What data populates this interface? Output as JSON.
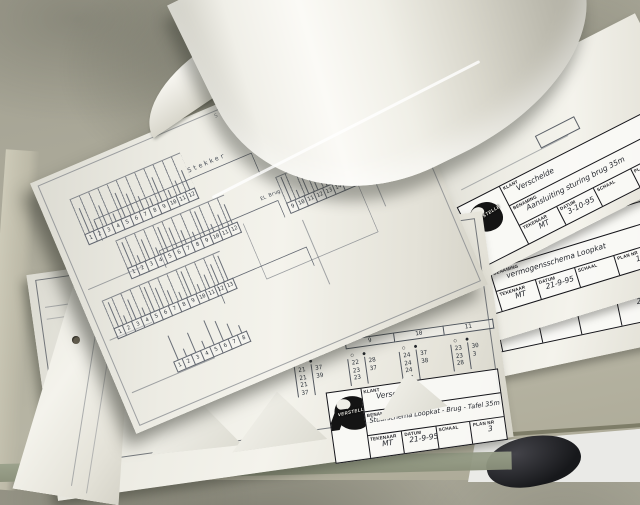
{
  "logo_text": "VERSTELLE",
  "tb_labels": {
    "klant": "KLANT",
    "benaming": "BENAMING",
    "tekenaar": "TEKENAAR",
    "datum": "DATUM",
    "schaal": "SCHAAL",
    "plan_nr": "PLAN NR"
  },
  "blocks": {
    "plan4": {
      "klant": "Verschelde",
      "benaming": "Aansluiting sturing brug 35m",
      "tekenaar": "MT",
      "datum": "3-10-95",
      "schaal": "",
      "plan_nr": "4"
    },
    "plan1": {
      "klant": "Verschelde",
      "benaming": "vermogensschema Loopkat",
      "tekenaar": "MT",
      "datum": "21-9-95",
      "schaal": "",
      "plan_nr": "1"
    },
    "plan2": {
      "klant": "Verschelde",
      "benaming": "vermogensschema Tafel - Brug",
      "tekenaar": "MT",
      "datum": "21-9-95",
      "schaal": "",
      "plan_nr": "2"
    },
    "plan3": {
      "klant": "Verschelde",
      "benaming": "Stuurschema Loopkat - Brug - Tafel 35m",
      "tekenaar": "MT",
      "datum": "21-9-95",
      "schaal": "",
      "plan_nr": "3"
    }
  },
  "schematic": {
    "labels": {
      "stekker": "Stekker",
      "klemmen_kast": "Klemmen kast",
      "el_brug": "EL Brug",
      "x5": "X5",
      "x2": "X2"
    },
    "strips": {
      "a": [
        "1",
        "2",
        "3",
        "4",
        "5",
        "6",
        "7",
        "8",
        "9",
        "10",
        "11",
        "12"
      ],
      "b": [
        "1",
        "2",
        "3",
        "4",
        "5",
        "6",
        "7",
        "8",
        "9",
        "10",
        "11",
        "12"
      ],
      "c": [
        "1",
        "2",
        "3",
        "4",
        "5",
        "6",
        "7",
        "8",
        "9",
        "10",
        "11",
        "12",
        "13"
      ],
      "d": [
        "1",
        "2",
        "3",
        "4",
        "5",
        "6",
        "7",
        "8"
      ],
      "e": [
        "9",
        "10",
        "11",
        "12",
        "13",
        "14",
        "15",
        "16",
        "17",
        "18"
      ],
      "f": [
        "19",
        "20",
        "21",
        "22",
        "23"
      ]
    },
    "relays": [
      "K0",
      "A1",
      "A2",
      "K1",
      "K2"
    ]
  },
  "tables": {
    "sym_open": "○",
    "sym_filled": "●",
    "left": {
      "headers": [
        "1",
        "2"
      ],
      "groups": [
        {
          "circle": [
            "11",
            "11",
            "12",
            "34"
          ],
          "dot": []
        },
        {
          "circle": [
            "15",
            "14",
            "14"
          ],
          "dot": [
            "13"
          ]
        }
      ]
    },
    "right": {
      "headers": [
        "9",
        "10",
        "11"
      ],
      "groups": [
        {
          "circle": [
            "21",
            "21",
            "21",
            "37"
          ],
          "dot": [
            "37",
            "39"
          ]
        },
        {
          "circle": [
            "22",
            "23",
            "23"
          ],
          "dot": [
            "28",
            "37"
          ]
        },
        {
          "circle": [
            "24",
            "24",
            "24",
            "37"
          ],
          "dot": [
            "37",
            "38"
          ]
        },
        {
          "circle": [
            "23",
            "23",
            "28"
          ],
          "dot": [
            "30",
            "3"
          ]
        }
      ]
    }
  },
  "colors": {
    "table_surface": "#adab9b",
    "paper": "#f2f1ea",
    "schematic_ink": "#6a6f78",
    "logo_black": "#141414",
    "boot_dark": "#17181b",
    "floor": "#eaeae7"
  }
}
